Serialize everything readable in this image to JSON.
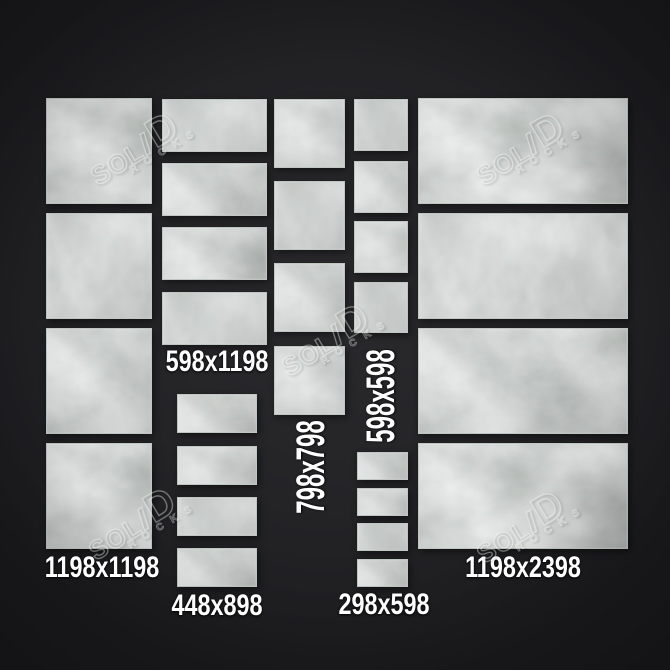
{
  "colors": {
    "background": "#242427",
    "tile_base": "#a9aeab",
    "label_text": "#ffffff",
    "watermark": "#f0f4f1"
  },
  "watermark": {
    "brand_parts": {
      "sol": "SOL",
      "i": "I",
      "d": "D"
    },
    "subtext": "ROCKS"
  },
  "watermarks": [
    {
      "x": 142,
      "y": 146
    },
    {
      "x": 528,
      "y": 146
    },
    {
      "x": 333,
      "y": 337
    },
    {
      "x": 140,
      "y": 521
    },
    {
      "x": 528,
      "y": 524
    }
  ],
  "groups": [
    {
      "size": "1198x1198",
      "label": "1198x1198",
      "label_x": 102,
      "label_y": 568,
      "label_rotate": 0,
      "tiles": [
        {
          "x": 46,
          "y": 98,
          "w": 106,
          "h": 106
        },
        {
          "x": 46,
          "y": 213,
          "w": 106,
          "h": 106
        },
        {
          "x": 46,
          "y": 328,
          "w": 106,
          "h": 106
        },
        {
          "x": 46,
          "y": 443,
          "w": 106,
          "h": 106
        }
      ]
    },
    {
      "size": "598x1198",
      "label": "598x1198",
      "label_x": 217,
      "label_y": 362,
      "label_rotate": 0,
      "tiles": [
        {
          "x": 162,
          "y": 99,
          "w": 105,
          "h": 53
        },
        {
          "x": 162,
          "y": 163,
          "w": 105,
          "h": 53
        },
        {
          "x": 162,
          "y": 227,
          "w": 105,
          "h": 53
        },
        {
          "x": 162,
          "y": 292,
          "w": 105,
          "h": 53
        }
      ]
    },
    {
      "size": "448x898",
      "label": "448x898",
      "label_x": 217,
      "label_y": 606,
      "label_rotate": 0,
      "tiles": [
        {
          "x": 177,
          "y": 394,
          "w": 80,
          "h": 39
        },
        {
          "x": 177,
          "y": 446,
          "w": 80,
          "h": 39
        },
        {
          "x": 177,
          "y": 497,
          "w": 80,
          "h": 39
        },
        {
          "x": 177,
          "y": 548,
          "w": 80,
          "h": 39
        }
      ]
    },
    {
      "size": "798x798",
      "label": "798x798",
      "label_x": 311,
      "label_y": 467,
      "label_rotate": -90,
      "tiles": [
        {
          "x": 274,
          "y": 99,
          "w": 71,
          "h": 69
        },
        {
          "x": 274,
          "y": 181,
          "w": 71,
          "h": 69
        },
        {
          "x": 274,
          "y": 263,
          "w": 71,
          "h": 69
        },
        {
          "x": 274,
          "y": 346,
          "w": 71,
          "h": 69
        }
      ]
    },
    {
      "size": "598x598",
      "label": "598x598",
      "label_x": 381,
      "label_y": 396,
      "label_rotate": -90,
      "tiles": [
        {
          "x": 354,
          "y": 99,
          "w": 54,
          "h": 52
        },
        {
          "x": 354,
          "y": 161,
          "w": 54,
          "h": 52
        },
        {
          "x": 354,
          "y": 221,
          "w": 54,
          "h": 52
        },
        {
          "x": 354,
          "y": 282,
          "w": 54,
          "h": 51
        }
      ]
    },
    {
      "size": "298x598",
      "label": "298x598",
      "label_x": 384,
      "label_y": 605,
      "label_rotate": 0,
      "tiles": [
        {
          "x": 357,
          "y": 452,
          "w": 51,
          "h": 28
        },
        {
          "x": 357,
          "y": 488,
          "w": 51,
          "h": 28
        },
        {
          "x": 357,
          "y": 523,
          "w": 51,
          "h": 28
        },
        {
          "x": 357,
          "y": 559,
          "w": 51,
          "h": 28
        }
      ]
    },
    {
      "size": "1198x2398",
      "label": "1198x2398",
      "label_x": 523,
      "label_y": 568,
      "label_rotate": 0,
      "tiles": [
        {
          "x": 418,
          "y": 98,
          "w": 210,
          "h": 106
        },
        {
          "x": 418,
          "y": 213,
          "w": 210,
          "h": 106
        },
        {
          "x": 418,
          "y": 328,
          "w": 210,
          "h": 106
        },
        {
          "x": 418,
          "y": 443,
          "w": 210,
          "h": 106
        }
      ]
    }
  ]
}
